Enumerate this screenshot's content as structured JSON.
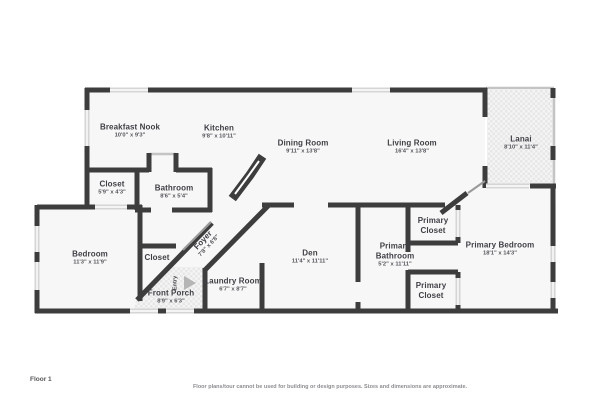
{
  "footer": {
    "floor_label": "Floor 1",
    "disclaimer": "Floor plans/tour cannot be used for building or design purposes. Sizes and dimensions are approximate."
  },
  "colors": {
    "wall": "#3d3d3d",
    "window": "#d5d5d5",
    "floor": "#f7f7f7",
    "hatch": "#e7e7e7",
    "label": "#3f3f46",
    "background": "#ffffff"
  },
  "rooms": {
    "breakfast_nook": {
      "name": "Breakfast Nook",
      "dims": "10'0\" x 9'3\""
    },
    "kitchen": {
      "name": "Kitchen",
      "dims": "9'8\" x 10'11\""
    },
    "dining_room": {
      "name": "Dining Room",
      "dims": "9'11\" x 13'8\""
    },
    "living_room": {
      "name": "Living Room",
      "dims": "16'4\" x 13'8\""
    },
    "lanai": {
      "name": "Lanai",
      "dims": "8'10\" x 11'4\""
    },
    "closet_upper": {
      "name": "Closet",
      "dims": "5'9\" x 4'3\""
    },
    "bathroom": {
      "name": "Bathroom",
      "dims": "8'6\" x 5'4\""
    },
    "bedroom": {
      "name": "Bedroom",
      "dims": "11'3\" x 11'9\""
    },
    "closet_bedroom": {
      "name": "Closet",
      "dims": ""
    },
    "foyer": {
      "name": "Foyer",
      "dims": "7'8\" x 6'8\""
    },
    "entry": {
      "name": "Entry",
      "dims": ""
    },
    "front_porch": {
      "name": "Front Porch",
      "dims": "8'9\" x 6'3\""
    },
    "laundry_room": {
      "name": "Laundry Room",
      "dims": "6'7\" x 8'7\""
    },
    "den": {
      "name": "Den",
      "dims": "11'4\" x 11'11\""
    },
    "primary_bathroom": {
      "name": "Primary Bathroom",
      "dims": "5'2\" x 11'11\""
    },
    "primary_closet_top": {
      "name": "Primary Closet",
      "dims": ""
    },
    "primary_closet_bottom": {
      "name": "Primary Closet",
      "dims": ""
    },
    "primary_bedroom": {
      "name": "Primary Bedroom",
      "dims": "18'1\" x 14'3\""
    }
  }
}
